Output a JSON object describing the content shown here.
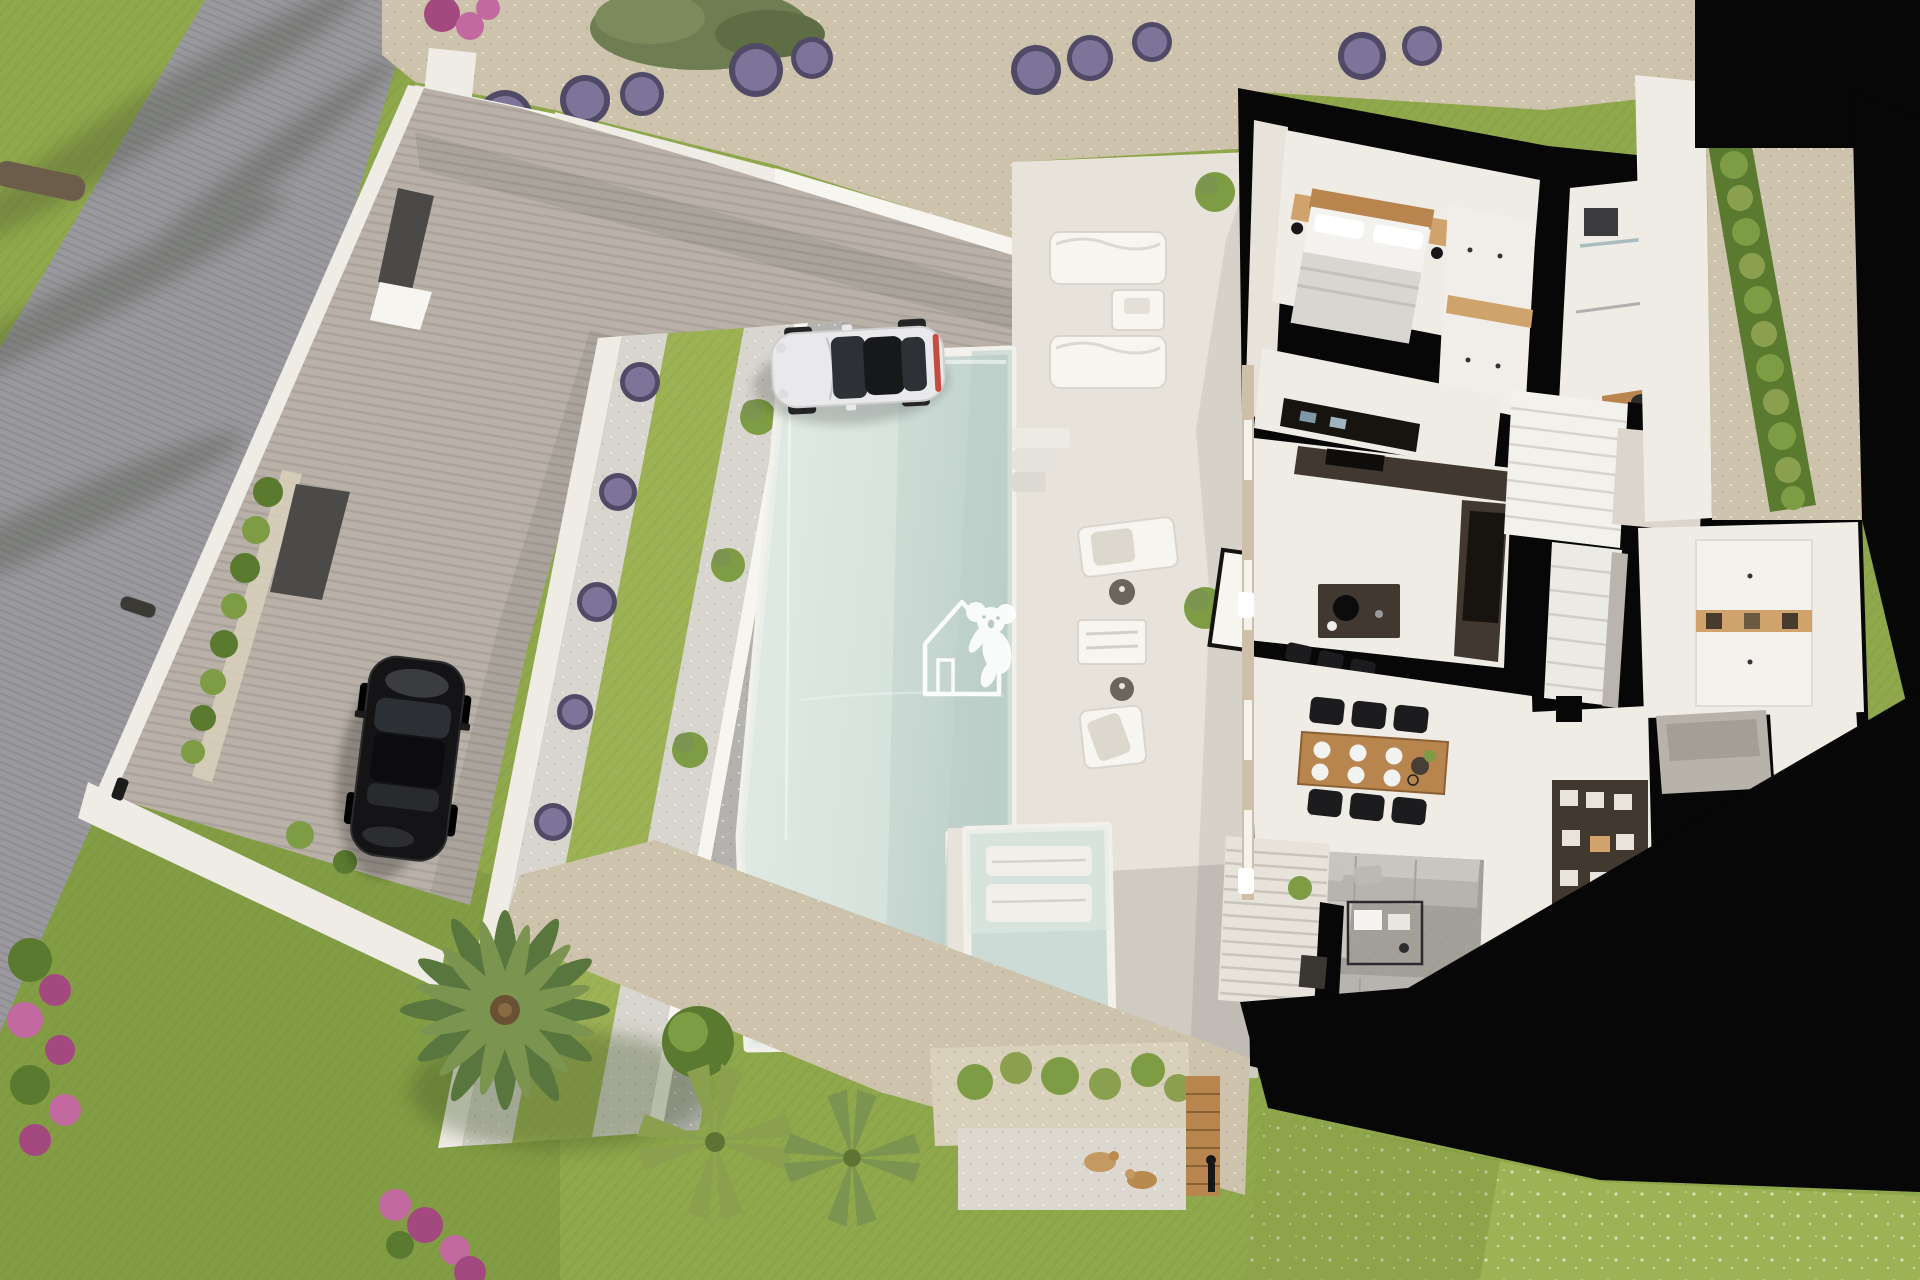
{
  "scene": {
    "view": "aerial-top-down-3d-render",
    "subject": "modern villa with cutaway ground-floor plan, infinity pool, terraced garden and driveway"
  },
  "watermark": {
    "name": "koala-house-logo"
  },
  "objects": {
    "road": "road",
    "lawn": "lawn",
    "driveway": "paved driveway",
    "boundary-wall": "white boundary wall",
    "entrance-gate": "dark entrance gate",
    "gravel-bed": "gravel bed",
    "lavender-bush": "lavender bush",
    "olive-tree": "olive tree",
    "retaining-walls": "white stepped retaining walls",
    "grass-strip": "terraced grass strip",
    "swimming-pool": "swimming pool",
    "plunge-pool": "plunge pool with in-water benches",
    "pool-deck": "white pool deck",
    "sun-lounger": "sun lounger",
    "side-table": "side table",
    "pool-steps": "pool entry steps",
    "white-car": "white sports car",
    "black-car": "black car",
    "house": "cutaway house floor plan",
    "bedroom": "bedroom with double bed",
    "wardrobe": "wardrobe",
    "bathroom": "bathroom with shower and vanity",
    "kitchen": "kitchen with dark island",
    "bar-stools": "bar stools",
    "staircase": "staircase",
    "dining-set": "wooden dining table with six black chairs",
    "living-room": "living room with grey sofas",
    "coffee-table": "coffee table",
    "tv": "television",
    "media-wall": "media shelf wall",
    "pantry": "utility room cabinets",
    "pergola": "slatted pergola terrace",
    "palm-tree": "palm tree",
    "fan-palm": "fan palm",
    "hedge": "clipped hedge",
    "flowers": "flowering shrubs",
    "planter": "planter with shrubs",
    "pebble-terrace": "pebble terrace",
    "pets": "two small pets",
    "garden-lamp": "garden lamp"
  },
  "colors": {
    "lawn": "#8fa84b",
    "lawn_light": "#9db254",
    "lawn_dark": "#5f7a30",
    "road": "#9a999e",
    "driveway": "#b9b1a8",
    "gravel": "#cdc2ab",
    "gravel_light": "#d9d0bc",
    "white_gravel": "#d7d5cd",
    "pebble_dark": "#b3b2ae",
    "wall_white": "#efece6",
    "wall_bright": "#f7f5f0",
    "deck": "#e7e2da",
    "deck_shadow": "#d4cec5",
    "pool": "#ccdbd5",
    "pool_light": "#e2ebe5",
    "pool_deep": "#b9cec8",
    "cut_wall": "#070707",
    "floor": "#efebe5",
    "floor_shadow": "#dcd5cc",
    "counter_dark": "#413830",
    "counter_black": "#17140f",
    "wood": "#b9854e",
    "wood_light": "#cfa36b",
    "sofa": "#b7b3ae",
    "sofa_light": "#c9c5bf",
    "rug": "#a3a09a",
    "chair_black": "#1c1c1e",
    "hedge": "#7d9c43",
    "hedge_dark": "#5a7a30",
    "palm": "#58763d",
    "palm_light": "#7b9450",
    "fanpalm": "#8ba04f",
    "lavender": "#8379a0",
    "lavender_dark": "#504a66",
    "flower_pink": "#c2699f",
    "flower_magenta": "#a4497f",
    "car_black": "#141416",
    "car_white": "#e9e9eb",
    "car_glass": "#2d3035",
    "metal": "#9a9a9a",
    "watermark": "#ffffff"
  }
}
